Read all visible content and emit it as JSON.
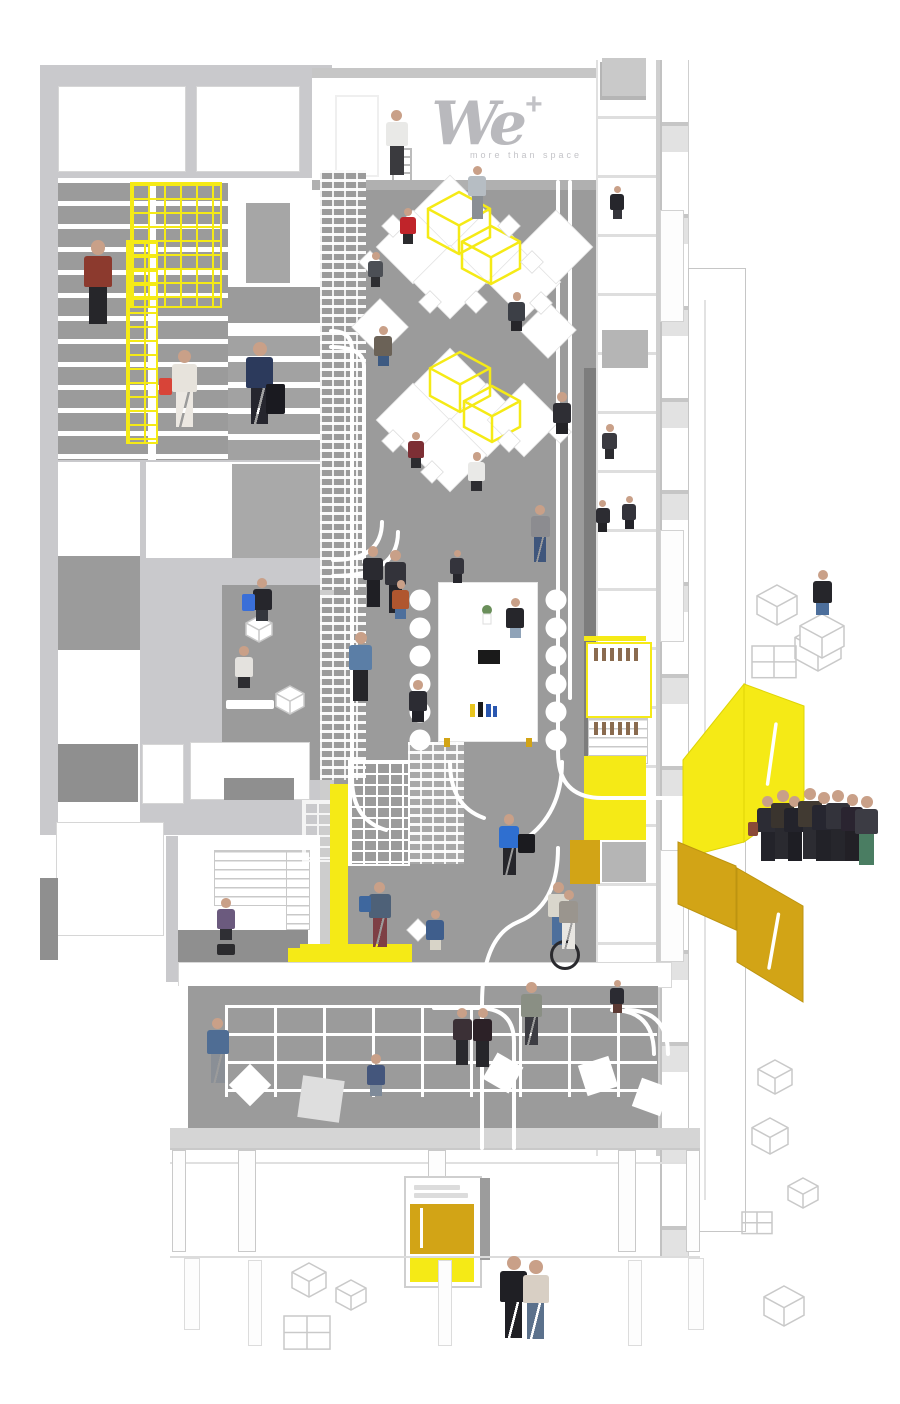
{
  "brand": {
    "logo_text": "We",
    "plus_sign": "+",
    "tagline": "more than space"
  },
  "palette": {
    "wall": "#c9c9cc",
    "floor": "#9b9b9b",
    "dark": "#7d7d7d",
    "yellow": "#f5ea16",
    "gold": "#d2a416",
    "out": "#c8c8c8",
    "skin": "#c9a088"
  },
  "figures": [
    {
      "n": "logo-painter",
      "x": 383,
      "y": 110,
      "h": 66,
      "t": "#e9e9e7",
      "l": "#3a3a3e",
      "p": "s"
    },
    {
      "n": "standing-desk-woman",
      "x": 466,
      "y": 166,
      "h": 54,
      "t": "#b6bdc3",
      "l": "#8a8f94",
      "p": "s"
    },
    {
      "n": "red-shirt-worker",
      "x": 398,
      "y": 208,
      "h": 48,
      "t": "#c0242a",
      "l": "#2b2b2e",
      "p": "c"
    },
    {
      "n": "tablet-worker",
      "x": 366,
      "y": 252,
      "h": 46,
      "t": "#4c4f55",
      "l": "#2e2e31",
      "p": "c"
    },
    {
      "n": "laptop-worker",
      "x": 372,
      "y": 326,
      "h": 54,
      "t": "#6b6257",
      "l": "#3d5a82",
      "p": "c"
    },
    {
      "n": "desk-woman-right",
      "x": 506,
      "y": 292,
      "h": 52,
      "t": "#3c3f46",
      "l": "#26262a",
      "p": "c"
    },
    {
      "n": "suited-worker-right",
      "x": 550,
      "y": 392,
      "h": 56,
      "t": "#2e2e34",
      "l": "#232327",
      "p": "c"
    },
    {
      "n": "desk-woman-2",
      "x": 406,
      "y": 432,
      "h": 48,
      "t": "#7d2f35",
      "l": "#2c2c30",
      "p": "c"
    },
    {
      "n": "white-shirt-worker",
      "x": 466,
      "y": 452,
      "h": 52,
      "t": "#e9e9e7",
      "l": "#2e2e32",
      "p": "c"
    },
    {
      "n": "cap-walker",
      "x": 528,
      "y": 505,
      "h": 58,
      "t": "#8c8c90",
      "l": "#3f567c",
      "p": "w"
    },
    {
      "n": "talking-businessman-1",
      "x": 360,
      "y": 546,
      "h": 62,
      "t": "#2a2a30",
      "l": "#1f1f24",
      "p": "s"
    },
    {
      "n": "talking-businessman-2",
      "x": 382,
      "y": 550,
      "h": 64,
      "t": "#33333a",
      "l": "#24242a",
      "p": "s"
    },
    {
      "n": "table-head-man",
      "x": 448,
      "y": 550,
      "h": 44,
      "t": "#34343c",
      "l": "#26262c",
      "p": "c"
    },
    {
      "n": "orange-top-woman",
      "x": 390,
      "y": 580,
      "h": 52,
      "t": "#b0562f",
      "l": "#4d6f9c",
      "p": "c"
    },
    {
      "n": "black-top-woman",
      "x": 504,
      "y": 598,
      "h": 54,
      "t": "#26262b",
      "l": "#8fa3b8",
      "p": "c"
    },
    {
      "n": "dark-suit-woman",
      "x": 406,
      "y": 680,
      "h": 56,
      "t": "#2c2c33",
      "l": "#222228",
      "p": "c"
    },
    {
      "n": "steps-sitter",
      "x": 250,
      "y": 578,
      "h": 58,
      "t": "#26262c",
      "l": "#33363c",
      "p": "c",
      "acc": {
        "dx": -8,
        "dy": 16,
        "w": 13,
        "h": 17,
        "c": "#3a6fd8",
        "shape": "rect"
      }
    },
    {
      "n": "phone-woman",
      "x": 232,
      "y": 646,
      "h": 56,
      "t": "#e4e2de",
      "l": "#2c2c30",
      "p": "c"
    },
    {
      "n": "shelf-leaner",
      "x": 346,
      "y": 632,
      "h": 70,
      "t": "#5b7ea6",
      "l": "#26262a",
      "p": "s"
    },
    {
      "n": "office-chair-man",
      "x": 214,
      "y": 898,
      "h": 56,
      "t": "#6b5a7e",
      "l": "#2f2f34",
      "p": "c",
      "acc": {
        "dx": 3,
        "dy": 46,
        "w": 18,
        "h": 11,
        "c": "#2b2b2e",
        "shape": "rect"
      }
    },
    {
      "n": "backpack-walker",
      "x": 366,
      "y": 882,
      "h": 66,
      "t": "#4e6178",
      "l": "#7e3f45",
      "p": "w",
      "acc": {
        "dx": -7,
        "dy": 14,
        "w": 12,
        "h": 16,
        "c": "#3e679e",
        "shape": "rect"
      }
    },
    {
      "n": "polo-sitter",
      "x": 424,
      "y": 910,
      "h": 54,
      "t": "#3f5e8c",
      "l": "#d8d4c8",
      "p": "c"
    },
    {
      "n": "hoodie-carrier",
      "x": 496,
      "y": 814,
      "h": 62,
      "t": "#2f6fd0",
      "l": "#26262b",
      "p": "w",
      "acc": {
        "dx": 22,
        "dy": 20,
        "w": 17,
        "h": 19,
        "c": "#1b1b1f",
        "shape": "rect"
      }
    },
    {
      "n": "unicyclist",
      "x": 545,
      "y": 882,
      "h": 64,
      "t": "#d9d6cc",
      "l": "#4d6f9c",
      "p": "s",
      "acc": {
        "dx": 5,
        "dy": 58,
        "w": 24,
        "h": 24,
        "c": "#2a2a2e",
        "shape": "ring"
      }
    },
    {
      "n": "corridor-walking-woman",
      "x": 556,
      "y": 890,
      "h": 60,
      "t": "#9a958e",
      "l": "#e8e6e2",
      "p": "w"
    },
    {
      "n": "booth-sitter-top",
      "x": 608,
      "y": 186,
      "h": 44,
      "t": "#26262c",
      "l": "#35353b",
      "p": "c"
    },
    {
      "n": "coffee-break-man",
      "x": 600,
      "y": 424,
      "h": 46,
      "t": "#3a3a40",
      "l": "#2c2c30",
      "p": "c"
    },
    {
      "n": "meeting-woman",
      "x": 594,
      "y": 500,
      "h": 42,
      "t": "#2c2c32",
      "l": "#222226",
      "p": "c"
    },
    {
      "n": "meeting-man",
      "x": 620,
      "y": 496,
      "h": 44,
      "t": "#33333b",
      "l": "#222228",
      "p": "c"
    },
    {
      "n": "booth-sitter-bottom",
      "x": 608,
      "y": 980,
      "h": 44,
      "t": "#2b2b32",
      "l": "#5c3a34",
      "p": "c"
    },
    {
      "n": "lounge-walker",
      "x": 204,
      "y": 1018,
      "h": 66,
      "t": "#4f6d94",
      "l": "#8a8f96",
      "p": "w"
    },
    {
      "n": "handshake-man-1",
      "x": 450,
      "y": 1008,
      "h": 58,
      "t": "#3b3036",
      "l": "#2a2a2e",
      "p": "s"
    },
    {
      "n": "handshake-man-2",
      "x": 470,
      "y": 1008,
      "h": 60,
      "t": "#2c2127",
      "l": "#26262a",
      "p": "s"
    },
    {
      "n": "lounge-sitting-woman",
      "x": 364,
      "y": 1054,
      "h": 56,
      "t": "#44567c",
      "l": "#7e8a99",
      "p": "c"
    },
    {
      "n": "cardigan-walker",
      "x": 518,
      "y": 982,
      "h": 64,
      "t": "#8a8f84",
      "l": "#3c3c42",
      "p": "w"
    },
    {
      "n": "cube-sitter",
      "x": 810,
      "y": 570,
      "h": 60,
      "t": "#26262b",
      "l": "#4d6f9c",
      "p": "c"
    },
    {
      "n": "crowd-1",
      "x": 754,
      "y": 796,
      "h": 66,
      "t": "#2c2c34",
      "l": "#23232a",
      "p": "s",
      "acc": {
        "dx": -6,
        "dy": 26,
        "w": 10,
        "h": 14,
        "c": "#8a4a38",
        "shape": "rect"
      }
    },
    {
      "n": "crowd-2",
      "x": 768,
      "y": 790,
      "h": 70,
      "t": "#3a342e",
      "l": "#2a2a30",
      "p": "s"
    },
    {
      "n": "crowd-3",
      "x": 781,
      "y": 796,
      "h": 66,
      "t": "#23232b",
      "l": "#1e1e24",
      "p": "s"
    },
    {
      "n": "crowd-4",
      "x": 795,
      "y": 788,
      "h": 72,
      "t": "#413a32",
      "l": "#2c2c32",
      "p": "s",
      "acc": {
        "dx": 18,
        "dy": 28,
        "w": 10,
        "h": 13,
        "c": "#a0522d",
        "shape": "rect"
      }
    },
    {
      "n": "crowd-5",
      "x": 809,
      "y": 792,
      "h": 70,
      "t": "#262630",
      "l": "#222228",
      "p": "s"
    },
    {
      "n": "crowd-6",
      "x": 823,
      "y": 790,
      "h": 72,
      "t": "#33333b",
      "l": "#26262c",
      "p": "s"
    },
    {
      "n": "crowd-7",
      "x": 838,
      "y": 794,
      "h": 68,
      "t": "#2a2430",
      "l": "#222026",
      "p": "s"
    },
    {
      "n": "crowd-8",
      "x": 852,
      "y": 796,
      "h": 70,
      "t": "#3c3c44",
      "l": "#4a7d62",
      "p": "s"
    },
    {
      "n": "couple-woman-dark",
      "x": 496,
      "y": 1256,
      "h": 84,
      "t": "#1f1f24",
      "l": "#1f1f24",
      "p": "w"
    },
    {
      "n": "couple-woman-floral",
      "x": 519,
      "y": 1260,
      "h": 80,
      "t": "#d8cfc4",
      "l": "#5b718c",
      "p": "w"
    },
    {
      "n": "plaid-shirt-man",
      "x": 80,
      "y": 240,
      "h": 86,
      "t": "#8c3a2e",
      "l": "#26262a",
      "p": "s"
    },
    {
      "n": "red-bag-woman",
      "x": 168,
      "y": 350,
      "h": 78,
      "t": "#e7e3dc",
      "l": "#ece8e2",
      "p": "w",
      "acc": {
        "dx": -9,
        "dy": 28,
        "w": 13,
        "h": 17,
        "c": "#d84438",
        "shape": "rect"
      }
    },
    {
      "n": "traveler-with-luggage",
      "x": 242,
      "y": 342,
      "h": 84,
      "t": "#2c3a5c",
      "l": "#26262e",
      "p": "w",
      "acc": {
        "dx": 24,
        "dy": 42,
        "w": 19,
        "h": 30,
        "c": "#1a1a20",
        "shape": "rect"
      }
    }
  ],
  "desks": [
    {
      "x": 450,
      "y": 212,
      "s": 52
    },
    {
      "x": 413,
      "y": 247,
      "s": 52
    },
    {
      "x": 487,
      "y": 247,
      "s": 52
    },
    {
      "x": 450,
      "y": 282,
      "s": 52
    },
    {
      "x": 524,
      "y": 282,
      "s": 52
    },
    {
      "x": 556,
      "y": 247,
      "s": 52
    },
    {
      "x": 450,
      "y": 385,
      "s": 52
    },
    {
      "x": 413,
      "y": 420,
      "s": 52
    },
    {
      "x": 487,
      "y": 420,
      "s": 52
    },
    {
      "x": 450,
      "y": 455,
      "s": 52
    },
    {
      "x": 524,
      "y": 420,
      "s": 52
    },
    {
      "x": 380,
      "y": 327,
      "s": 40
    },
    {
      "x": 548,
      "y": 330,
      "s": 40
    }
  ],
  "chairs": [
    [
      393,
      226
    ],
    [
      509,
      226
    ],
    [
      430,
      302
    ],
    [
      476,
      302
    ],
    [
      541,
      303
    ],
    [
      393,
      441
    ],
    [
      509,
      441
    ],
    [
      432,
      472
    ],
    [
      560,
      432
    ],
    [
      370,
      262
    ],
    [
      532,
      262
    ],
    [
      418,
      930
    ]
  ],
  "yellow_frames": [
    {
      "x": 428,
      "y": 192,
      "s": 62
    },
    {
      "x": 462,
      "y": 226,
      "s": 58
    },
    {
      "x": 430,
      "y": 352,
      "s": 60
    },
    {
      "x": 464,
      "y": 386,
      "s": 56
    }
  ],
  "cubes": [
    {
      "x": 757,
      "y": 585,
      "s": 40,
      "k": "wire"
    },
    {
      "x": 795,
      "y": 625,
      "s": 46,
      "k": "wire"
    },
    {
      "x": 800,
      "y": 614,
      "s": 44,
      "k": "seat"
    },
    {
      "x": 752,
      "y": 646,
      "s": 44,
      "k": "grid"
    },
    {
      "x": 758,
      "y": 1060,
      "s": 34,
      "k": "wire"
    },
    {
      "x": 752,
      "y": 1118,
      "s": 36,
      "k": "wire"
    },
    {
      "x": 788,
      "y": 1178,
      "s": 30,
      "k": "wire"
    },
    {
      "x": 742,
      "y": 1212,
      "s": 30,
      "k": "grid"
    },
    {
      "x": 764,
      "y": 1286,
      "s": 40,
      "k": "wire"
    },
    {
      "x": 292,
      "y": 1263,
      "s": 34,
      "k": "wire"
    },
    {
      "x": 336,
      "y": 1280,
      "s": 30,
      "k": "wire"
    },
    {
      "x": 284,
      "y": 1316,
      "s": 46,
      "k": "grid"
    },
    {
      "x": 246,
      "y": 616,
      "s": 26,
      "k": "seat"
    },
    {
      "x": 276,
      "y": 686,
      "s": 28,
      "k": "seat"
    }
  ],
  "roads": [
    "M331,331 Q352,331 352,350 L352,778",
    "M331,347 Q364,347 364,366 L364,562",
    "M558,182 L558,752 Q558,798 602,798 L686,798",
    "M570,182 L570,698",
    "M558,848 Q558,906 518,922 Q482,937 482,1004 L482,1148",
    "M514,1148 L514,1042 Q514,1008 478,1008 L434,1008",
    "M450,762 Q450,806 484,818",
    "M562,762 Q562,814 524,840",
    "M612,1010 Q654,1010 654,1054",
    "M626,1010 Q668,1010 668,1054",
    "M333,560 Q382,560 382,522",
    "M333,576 Q398,576 398,532",
    "M352,778 Q352,820 386,830"
  ],
  "table_chairs": [
    [
      420,
      600
    ],
    [
      420,
      628
    ],
    [
      420,
      656
    ],
    [
      420,
      684
    ],
    [
      420,
      712
    ],
    [
      420,
      740
    ],
    [
      556,
      600
    ],
    [
      556,
      628
    ],
    [
      556,
      656
    ],
    [
      556,
      684
    ],
    [
      556,
      712
    ],
    [
      556,
      740
    ]
  ]
}
